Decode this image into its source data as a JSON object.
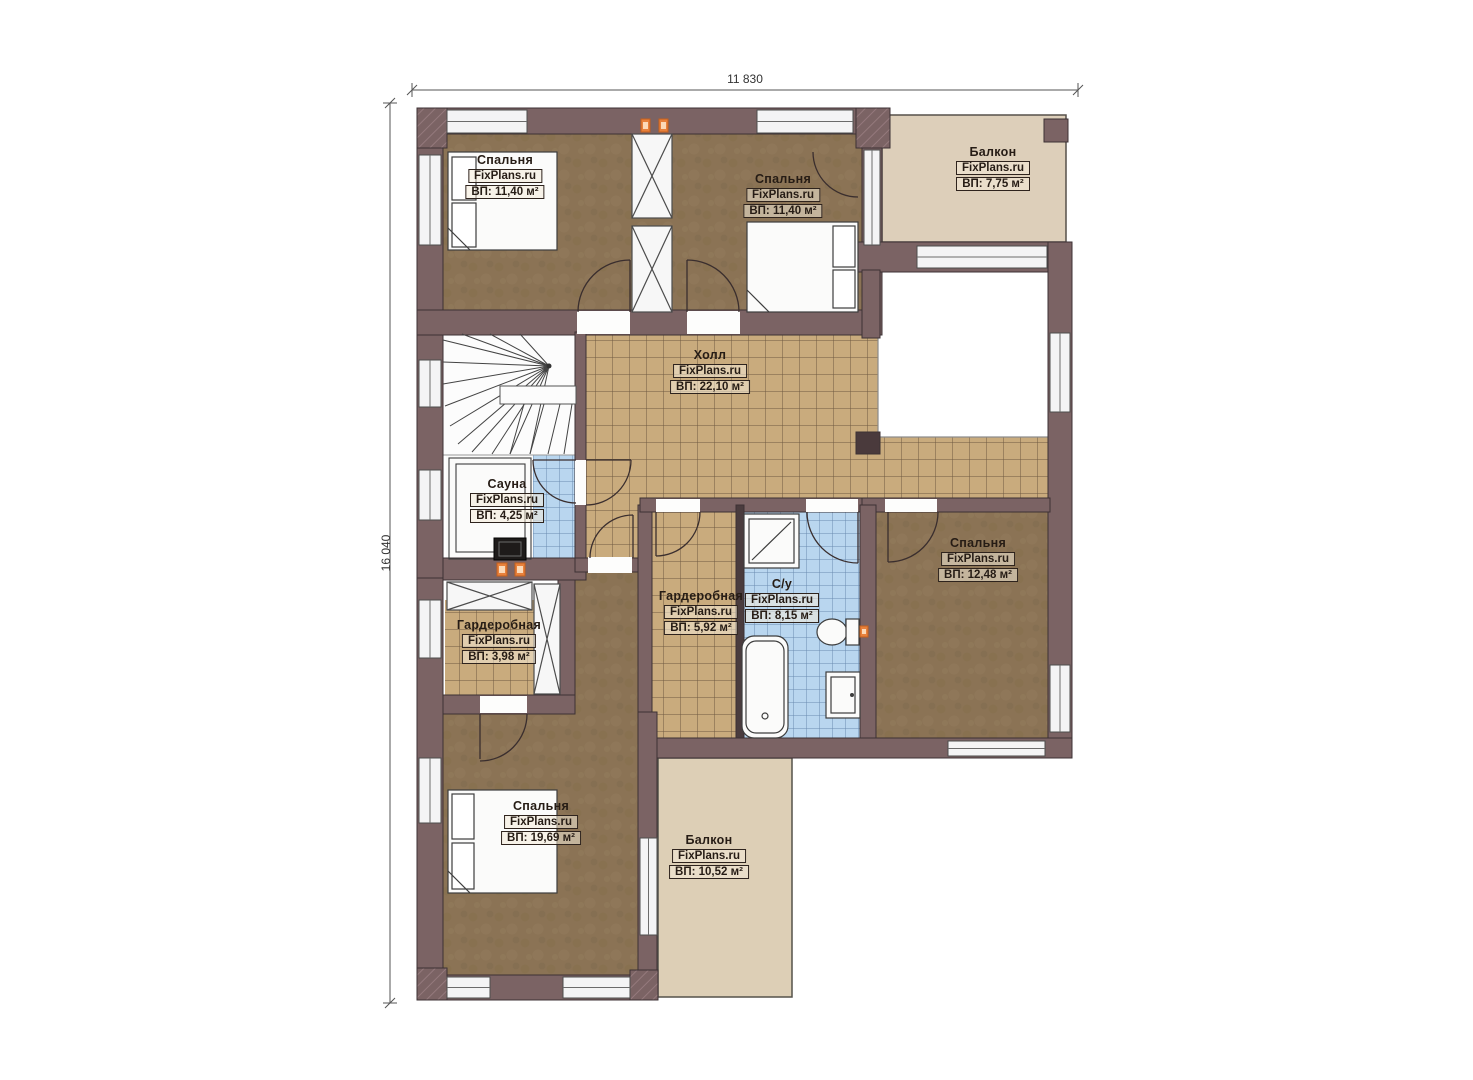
{
  "dimensions": {
    "width_label": "11 830",
    "height_label": "16 040"
  },
  "rooms": [
    {
      "id": "bedroom-top-left",
      "name": "Спальня",
      "watermark": "FixPlans.ru",
      "area": "ВП: 11,40 м²"
    },
    {
      "id": "bedroom-top-right",
      "name": "Спальня",
      "watermark": "FixPlans.ru",
      "area": "ВП: 11,40 м²"
    },
    {
      "id": "balcony-top",
      "name": "Балкон",
      "watermark": "FixPlans.ru",
      "area": "ВП: 7,75 м²"
    },
    {
      "id": "hall",
      "name": "Холл",
      "watermark": "FixPlans.ru",
      "area": "ВП: 22,10 м²"
    },
    {
      "id": "sauna",
      "name": "Сауна",
      "watermark": "FixPlans.ru",
      "area": "ВП: 4,25 м²"
    },
    {
      "id": "wardrobe-left",
      "name": "Гардеробная",
      "watermark": "FixPlans.ru",
      "area": "ВП: 3,98 м²"
    },
    {
      "id": "wardrobe-middle",
      "name": "Гардеробная",
      "watermark": "FixPlans.ru",
      "area": "ВП: 5,92 м²"
    },
    {
      "id": "bathroom",
      "name": "С/у",
      "watermark": "FixPlans.ru",
      "area": "ВП: 8,15 м²"
    },
    {
      "id": "bedroom-right",
      "name": "Спальня",
      "watermark": "FixPlans.ru",
      "area": "ВП: 12,48 м²"
    },
    {
      "id": "bedroom-bottom",
      "name": "Спальня",
      "watermark": "FixPlans.ru",
      "area": "ВП: 19,69 м²"
    },
    {
      "id": "balcony-bottom",
      "name": "Балкон",
      "watermark": "FixPlans.ru",
      "area": "ВП: 10,52 м²"
    }
  ],
  "colors": {
    "wall": "#7b6364",
    "wall_outline": "#3c3134",
    "wood_floor": "#8b7355",
    "tile_tan": "#c9ab7d",
    "tile_blue": "#b9d6ef",
    "balcony_floor": "#ddcfba",
    "accent_orange": "#e8813c"
  }
}
